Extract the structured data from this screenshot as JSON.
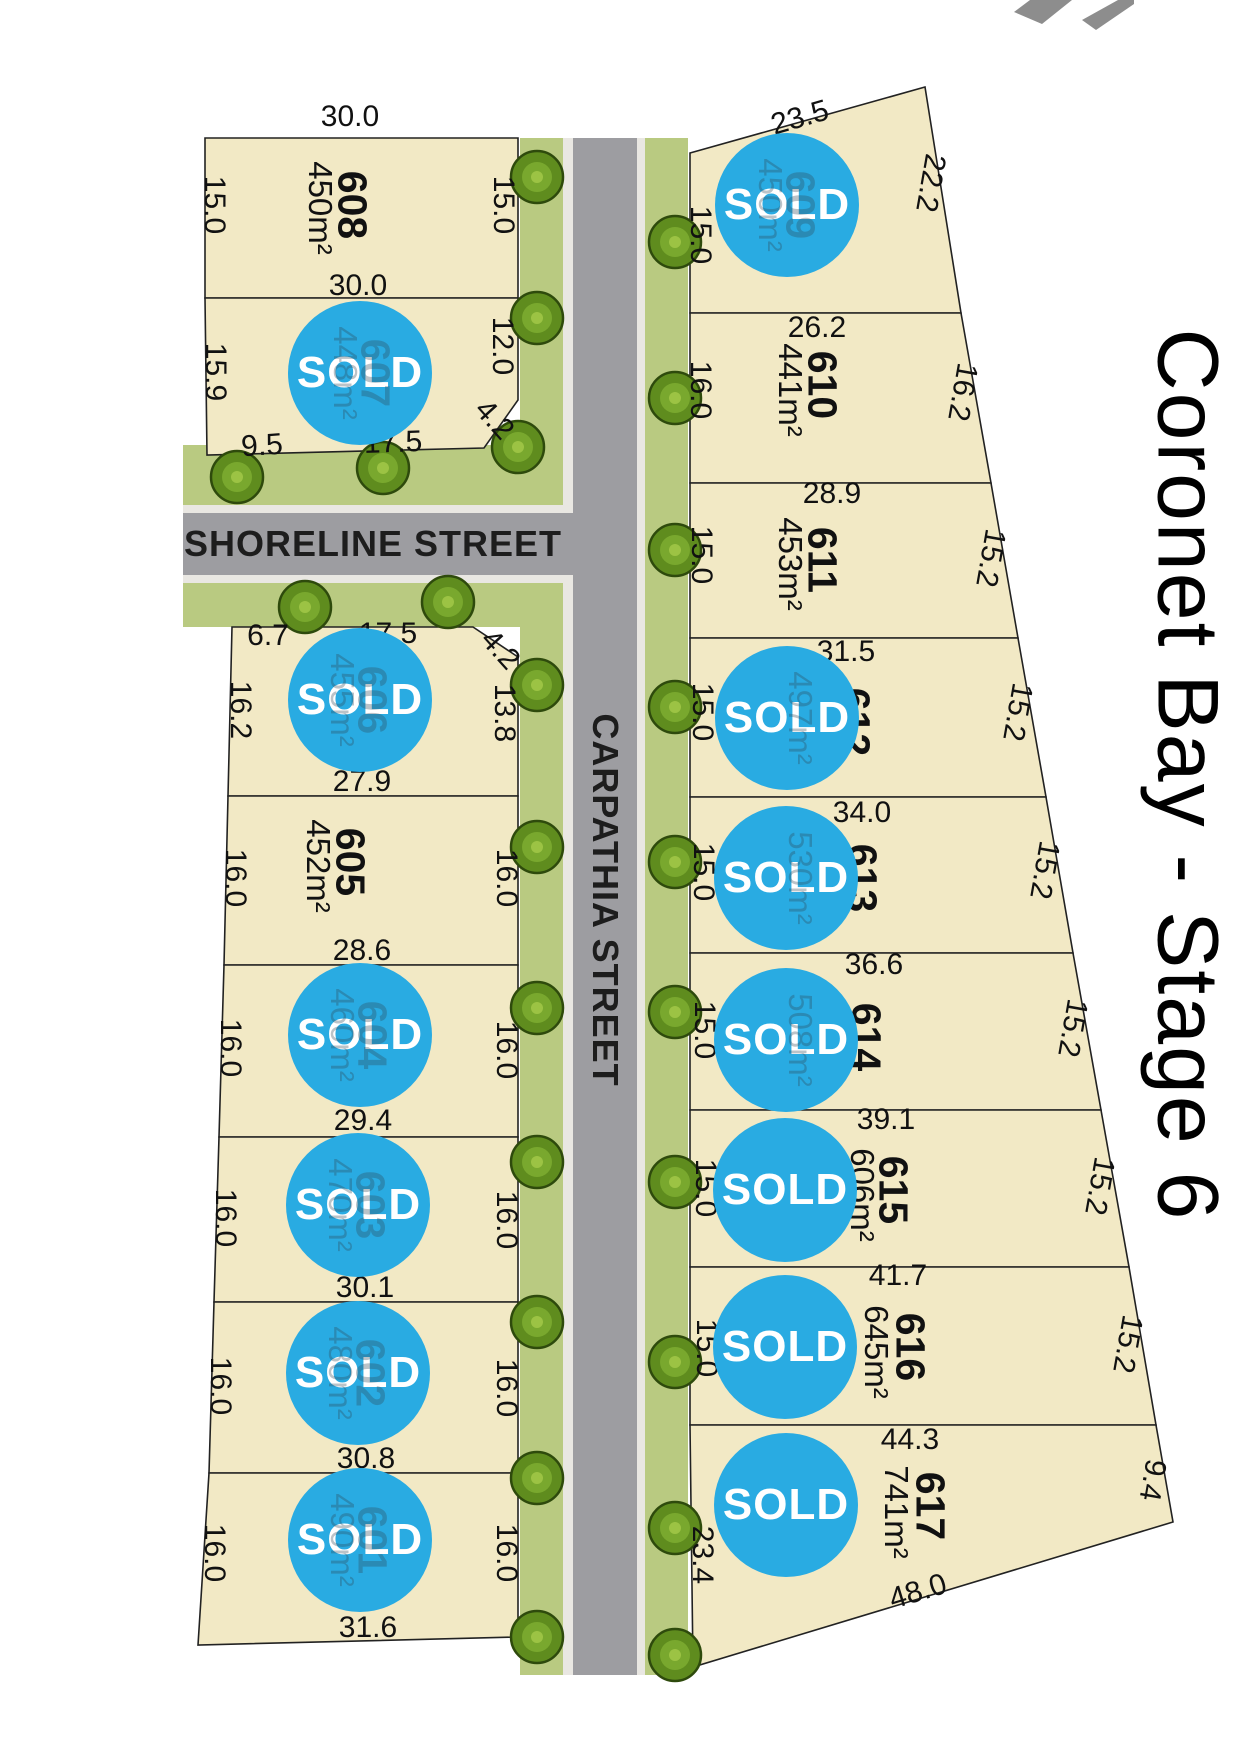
{
  "title": "Coronet Bay - Stage 6",
  "streets": {
    "shoreline": "SHORELINE STREET",
    "carpathia": "CARPATHIA STREET"
  },
  "sold_badge": "SOLD",
  "colors": {
    "lot_fill": "#f2e9c5",
    "road": "#9d9da1",
    "curb": "#e9e7e2",
    "verge": "#b9ca81",
    "tree": "#5f8c1e",
    "sold_circle": "#29abe2",
    "boundary": "#222222"
  },
  "lots": [
    {
      "number": "601",
      "area": "490m²",
      "status": "sold",
      "number_obscured": true,
      "area_obscured": true,
      "dims": {
        "left": "16.0",
        "right": "16.0",
        "bottom": "31.6"
      }
    },
    {
      "number": "602",
      "area": "480m²",
      "status": "sold",
      "number_obscured": true,
      "area_obscured": true,
      "dims": {
        "left": "16.0",
        "right": "16.0",
        "bottom": "30.8"
      }
    },
    {
      "number": "603",
      "area": "470m²",
      "status": "sold",
      "number_obscured": true,
      "area_obscured": true,
      "dims": {
        "left": "16.0",
        "right": "16.0",
        "bottom": "30.1"
      }
    },
    {
      "number": "604",
      "area": "460m²",
      "status": "sold",
      "number_obscured": true,
      "area_obscured": true,
      "dims": {
        "left": "16.0",
        "right": "16.0",
        "bottom": "29.4"
      }
    },
    {
      "number": "605",
      "area": "452m²",
      "status": "available",
      "number_obscured": false,
      "area_obscured": false,
      "dims": {
        "left": "16.0",
        "right": "16.0",
        "bottom": "28.6"
      }
    },
    {
      "number": "606",
      "area": "455m²",
      "status": "sold",
      "number_obscured": true,
      "area_obscured": true,
      "dims": {
        "top1": "6.7",
        "top2": "17.5",
        "corner": "4.2",
        "left": "16.2",
        "right": "13.8",
        "bottom": "27.9"
      }
    },
    {
      "number": "607",
      "area": "448m²",
      "status": "sold",
      "number_obscured": true,
      "area_obscured": true,
      "dims": {
        "left": "15.9",
        "right": "12.0",
        "corner": "4.2",
        "bottom1": "9.5",
        "bottom2": "17.5"
      }
    },
    {
      "number": "608",
      "area": "450m²",
      "status": "available",
      "number_obscured": false,
      "area_obscured": false,
      "dims": {
        "top": "30.0",
        "left": "15.0",
        "right": "15.0",
        "bottom": "30.0"
      }
    },
    {
      "number": "609",
      "area": "450m²",
      "status": "sold",
      "number_obscured": true,
      "area_obscured": true,
      "dims": {
        "top": "23.5",
        "left": "15.0",
        "right": "22.2",
        "bottom": "26.2"
      }
    },
    {
      "number": "610",
      "area": "441m²",
      "status": "available",
      "number_obscured": false,
      "area_obscured": false,
      "dims": {
        "left": "16.0",
        "right": "16.2",
        "bottom": "28.9"
      }
    },
    {
      "number": "611",
      "area": "453m²",
      "status": "available",
      "number_obscured": false,
      "area_obscured": false,
      "dims": {
        "left": "15.0",
        "right": "15.2",
        "bottom": "31.5"
      }
    },
    {
      "number": "612",
      "area": "497m²",
      "status": "sold",
      "number_obscured": false,
      "area_obscured": true,
      "dims": {
        "left": "15.0",
        "right": "15.2",
        "bottom": "34.0"
      }
    },
    {
      "number": "613",
      "area": "530m²",
      "status": "sold",
      "number_obscured": false,
      "area_obscured": true,
      "dims": {
        "left": "15.0",
        "right": "15.2",
        "bottom": "36.6"
      }
    },
    {
      "number": "614",
      "area": "508m²",
      "status": "sold",
      "number_obscured": false,
      "area_obscured": true,
      "dims": {
        "left": "15.0",
        "right": "15.2",
        "bottom": "39.1"
      }
    },
    {
      "number": "615",
      "area": "606m²",
      "status": "sold",
      "number_obscured": false,
      "area_obscured": false,
      "dims": {
        "left": "15.0",
        "right": "15.2",
        "bottom": "41.7"
      }
    },
    {
      "number": "616",
      "area": "645m²",
      "status": "sold",
      "number_obscured": false,
      "area_obscured": false,
      "dims": {
        "left": "15.0",
        "right": "15.2",
        "bottom": "44.3"
      }
    },
    {
      "number": "617",
      "area": "741m²",
      "status": "sold",
      "number_obscured": false,
      "area_obscured": false,
      "dims": {
        "left": "23.4",
        "right": "9.4",
        "bottom": "48.0"
      }
    }
  ]
}
